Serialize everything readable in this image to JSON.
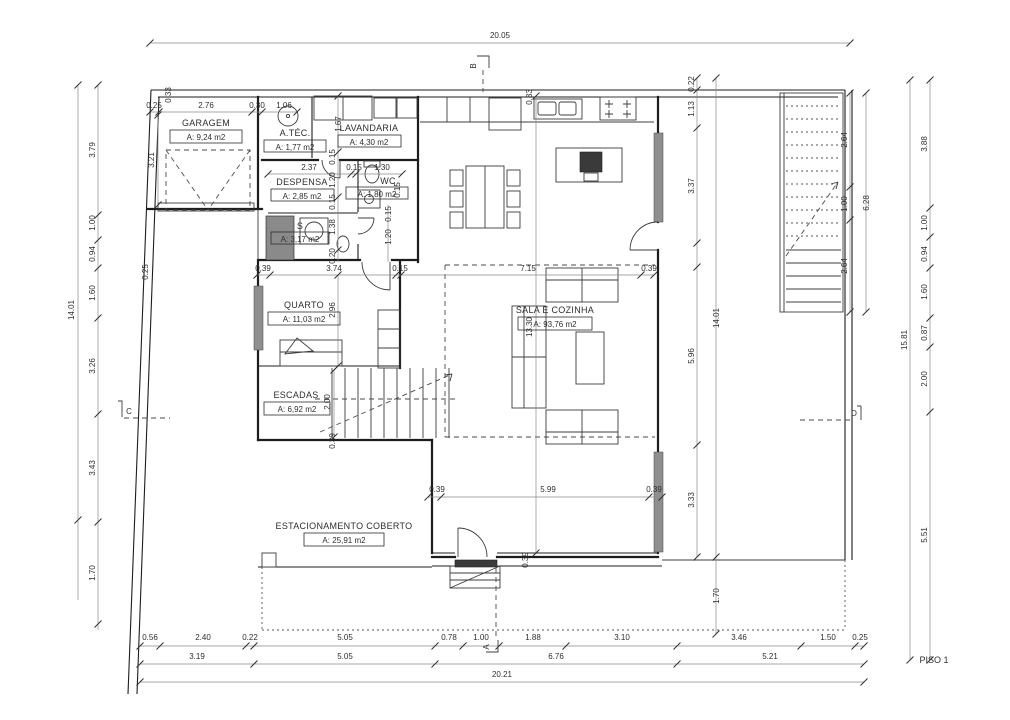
{
  "drawing": {
    "floor_label": "PISO 1"
  },
  "rooms": [
    {
      "name": "GARAGEM",
      "area": "A: 9,24 m2"
    },
    {
      "name": "A.TÉC.",
      "area": "A: 1,77 m2"
    },
    {
      "name": "LAVANDARIA",
      "area": "A: 4,30 m2"
    },
    {
      "name": "DESPENSA",
      "area": "A: 2,85 m2"
    },
    {
      "name": "WC",
      "area": "A: 1,80 m2"
    },
    {
      "name": "S",
      "area": "A: 3,17 m2"
    },
    {
      "name": "QUARTO",
      "area": "A: 11,03 m2"
    },
    {
      "name": "ESCADAS",
      "area": "A: 6,92 m2"
    },
    {
      "name": "SALA E COZINHA",
      "area": "A: 93,76 m2"
    },
    {
      "name": "ESTACIONAMENTO COBERTO",
      "area": "A: 25,91 m2"
    }
  ],
  "section_markers": [
    {
      "letter": "A"
    },
    {
      "letter": "B"
    },
    {
      "letter": "C"
    },
    {
      "letter": "D"
    }
  ],
  "colors": {
    "line": "#1d1d1d",
    "dim_text": "#2e2e2e",
    "window": "#8f8f8f"
  },
  "dimensions": [
    {
      "v": "20.05",
      "x": 500,
      "y": 38,
      "r": 0
    },
    {
      "v": "0.25",
      "x": 154,
      "y": 108,
      "r": 0
    },
    {
      "v": "2.76",
      "x": 206,
      "y": 108,
      "r": 0
    },
    {
      "v": "0.30",
      "x": 257,
      "y": 108,
      "r": 0
    },
    {
      "v": "1.06",
      "x": 284,
      "y": 108,
      "r": 0
    },
    {
      "v": "0.33",
      "x": 171,
      "y": 95,
      "r": 1
    },
    {
      "v": "3.21",
      "x": 154,
      "y": 160,
      "r": 1
    },
    {
      "v": "0.25",
      "x": 148,
      "y": 272,
      "r": 1
    },
    {
      "v": "3.79",
      "x": 95,
      "y": 150,
      "r": 1
    },
    {
      "v": "1.00",
      "x": 95,
      "y": 223,
      "r": 1
    },
    {
      "v": "0.94",
      "x": 95,
      "y": 254,
      "r": 1
    },
    {
      "v": "1.60",
      "x": 95,
      "y": 293,
      "r": 1
    },
    {
      "v": "3.26",
      "x": 95,
      "y": 366,
      "r": 1
    },
    {
      "v": "3.43",
      "x": 95,
      "y": 468,
      "r": 1
    },
    {
      "v": "1.70",
      "x": 95,
      "y": 573,
      "r": 1
    },
    {
      "v": "14.01",
      "x": 74,
      "y": 310,
      "r": 1
    },
    {
      "v": "3.88",
      "x": 927,
      "y": 144,
      "r": 1
    },
    {
      "v": "1.00",
      "x": 927,
      "y": 223,
      "r": 1
    },
    {
      "v": "0.94",
      "x": 927,
      "y": 254,
      "r": 1
    },
    {
      "v": "1.60",
      "x": 927,
      "y": 292,
      "r": 1
    },
    {
      "v": "0.87",
      "x": 927,
      "y": 333,
      "r": 1
    },
    {
      "v": "2.00",
      "x": 927,
      "y": 379,
      "r": 1
    },
    {
      "v": "5.51",
      "x": 927,
      "y": 535,
      "r": 1
    },
    {
      "v": "15.81",
      "x": 907,
      "y": 340,
      "r": 1
    },
    {
      "v": "2.64",
      "x": 847,
      "y": 140,
      "r": 1
    },
    {
      "v": "1.00",
      "x": 847,
      "y": 204,
      "r": 1
    },
    {
      "v": "2.64",
      "x": 847,
      "y": 266,
      "r": 1
    },
    {
      "v": "6.28",
      "x": 869,
      "y": 203,
      "r": 1
    },
    {
      "v": "0.22",
      "x": 694,
      "y": 84,
      "r": 1
    },
    {
      "v": "1.13",
      "x": 694,
      "y": 109,
      "r": 1
    },
    {
      "v": "3.37",
      "x": 694,
      "y": 186,
      "r": 1
    },
    {
      "v": "5.96",
      "x": 694,
      "y": 356,
      "r": 1
    },
    {
      "v": "3.33",
      "x": 694,
      "y": 500,
      "r": 1
    },
    {
      "v": "14.01",
      "x": 719,
      "y": 318,
      "r": 1
    },
    {
      "v": "1.70",
      "x": 719,
      "y": 596,
      "r": 1
    },
    {
      "v": "0.33",
      "x": 532,
      "y": 97,
      "r": 1
    },
    {
      "v": "1.67",
      "x": 341,
      "y": 124,
      "r": 1
    },
    {
      "v": "0.15",
      "x": 335,
      "y": 157,
      "r": 1
    },
    {
      "v": "1.20",
      "x": 335,
      "y": 180,
      "r": 1
    },
    {
      "v": "0.15",
      "x": 335,
      "y": 202,
      "r": 1
    },
    {
      "v": "1.38",
      "x": 335,
      "y": 227,
      "r": 1
    },
    {
      "v": "0.20",
      "x": 335,
      "y": 256,
      "r": 1
    },
    {
      "v": "2.37",
      "x": 309,
      "y": 170,
      "r": 0
    },
    {
      "v": "0.15",
      "x": 354,
      "y": 170,
      "r": 0
    },
    {
      "v": "1.30",
      "x": 382,
      "y": 170,
      "r": 0
    },
    {
      "v": "0.15",
      "x": 400,
      "y": 190,
      "r": 1
    },
    {
      "v": "0.15",
      "x": 391,
      "y": 214,
      "r": 1
    },
    {
      "v": "1.20",
      "x": 391,
      "y": 237,
      "r": 1
    },
    {
      "v": "0.39",
      "x": 263,
      "y": 271,
      "r": 0
    },
    {
      "v": "3.74",
      "x": 334,
      "y": 271,
      "r": 0
    },
    {
      "v": "0.15",
      "x": 400,
      "y": 271,
      "r": 0
    },
    {
      "v": "7.15",
      "x": 528,
      "y": 271,
      "r": 0
    },
    {
      "v": "0.39",
      "x": 649,
      "y": 271,
      "r": 0
    },
    {
      "v": "2.96",
      "x": 335,
      "y": 310,
      "r": 1
    },
    {
      "v": "2.00",
      "x": 330,
      "y": 402,
      "r": 1
    },
    {
      "v": "0.39",
      "x": 335,
      "y": 441,
      "r": 1
    },
    {
      "v": "13.30",
      "x": 532,
      "y": 327,
      "r": 1
    },
    {
      "v": "0.39",
      "x": 437,
      "y": 492,
      "r": 0
    },
    {
      "v": "5.99",
      "x": 548,
      "y": 492,
      "r": 0
    },
    {
      "v": "0.39",
      "x": 654,
      "y": 492,
      "r": 0
    },
    {
      "v": "0.39",
      "x": 528,
      "y": 560,
      "r": 1
    },
    {
      "v": "0.56",
      "x": 150,
      "y": 640,
      "r": 0
    },
    {
      "v": "2.40",
      "x": 203,
      "y": 640,
      "r": 0
    },
    {
      "v": "0.22",
      "x": 250,
      "y": 640,
      "r": 0
    },
    {
      "v": "5.05",
      "x": 345,
      "y": 640,
      "r": 0
    },
    {
      "v": "0.78",
      "x": 449,
      "y": 640,
      "r": 0
    },
    {
      "v": "1.00",
      "x": 481,
      "y": 640,
      "r": 0
    },
    {
      "v": "1.88",
      "x": 533,
      "y": 640,
      "r": 0
    },
    {
      "v": "3.10",
      "x": 622,
      "y": 640,
      "r": 0
    },
    {
      "v": "3.46",
      "x": 739,
      "y": 640,
      "r": 0
    },
    {
      "v": "1.50",
      "x": 828,
      "y": 640,
      "r": 0
    },
    {
      "v": "0.25",
      "x": 860,
      "y": 640,
      "r": 0
    },
    {
      "v": "3.19",
      "x": 197,
      "y": 659,
      "r": 0
    },
    {
      "v": "5.05",
      "x": 345,
      "y": 659,
      "r": 0
    },
    {
      "v": "6.76",
      "x": 556,
      "y": 659,
      "r": 0
    },
    {
      "v": "5.21",
      "x": 770,
      "y": 659,
      "r": 0
    },
    {
      "v": "20.21",
      "x": 502,
      "y": 677,
      "r": 0
    }
  ],
  "ticks": [
    [
      150,
      43
    ],
    [
      850,
      43
    ],
    [
      150,
      112
    ],
    [
      159,
      112
    ],
    [
      252,
      112
    ],
    [
      262,
      112
    ],
    [
      297,
      112
    ],
    [
      158,
      115
    ],
    [
      158,
      205
    ],
    [
      78,
      85
    ],
    [
      78,
      520
    ],
    [
      98,
      85
    ],
    [
      98,
      215
    ],
    [
      98,
      240
    ],
    [
      98,
      268
    ],
    [
      98,
      318
    ],
    [
      98,
      414
    ],
    [
      98,
      522
    ],
    [
      98,
      624
    ],
    [
      910,
      80
    ],
    [
      910,
      660
    ],
    [
      930,
      80
    ],
    [
      930,
      208
    ],
    [
      930,
      237
    ],
    [
      930,
      268
    ],
    [
      930,
      318
    ],
    [
      930,
      347
    ],
    [
      930,
      412
    ],
    [
      930,
      660
    ],
    [
      850,
      93
    ],
    [
      850,
      187
    ],
    [
      850,
      220
    ],
    [
      850,
      312
    ],
    [
      866,
      93
    ],
    [
      866,
      312
    ],
    [
      697,
      78
    ],
    [
      697,
      90
    ],
    [
      697,
      128
    ],
    [
      697,
      243
    ],
    [
      697,
      267
    ],
    [
      697,
      445
    ],
    [
      697,
      557
    ],
    [
      716,
      78
    ],
    [
      716,
      557
    ],
    [
      716,
      634
    ],
    [
      140,
      646
    ],
    [
      160,
      646
    ],
    [
      246,
      646
    ],
    [
      254,
      646
    ],
    [
      435,
      646
    ],
    [
      463,
      646
    ],
    [
      499,
      646
    ],
    [
      566,
      646
    ],
    [
      677,
      646
    ],
    [
      801,
      646
    ],
    [
      855,
      646
    ],
    [
      864,
      646
    ],
    [
      140,
      664
    ],
    [
      254,
      664
    ],
    [
      435,
      664
    ],
    [
      677,
      664
    ],
    [
      864,
      664
    ],
    [
      140,
      682
    ],
    [
      864,
      682
    ],
    [
      257,
      275
    ],
    [
      270,
      275
    ],
    [
      396,
      275
    ],
    [
      401,
      275
    ],
    [
      641,
      275
    ],
    [
      654,
      275
    ],
    [
      428,
      497
    ],
    [
      441,
      497
    ],
    [
      649,
      497
    ],
    [
      662,
      497
    ],
    [
      268,
      174
    ],
    [
      351,
      174
    ],
    [
      356,
      174
    ],
    [
      402,
      174
    ],
    [
      338,
      96
    ],
    [
      338,
      152
    ],
    [
      338,
      197
    ],
    [
      338,
      250
    ],
    [
      338,
      275
    ],
    [
      338,
      366
    ],
    [
      334,
      370
    ],
    [
      334,
      437
    ],
    [
      536,
      96
    ],
    [
      536,
      553
    ]
  ]
}
